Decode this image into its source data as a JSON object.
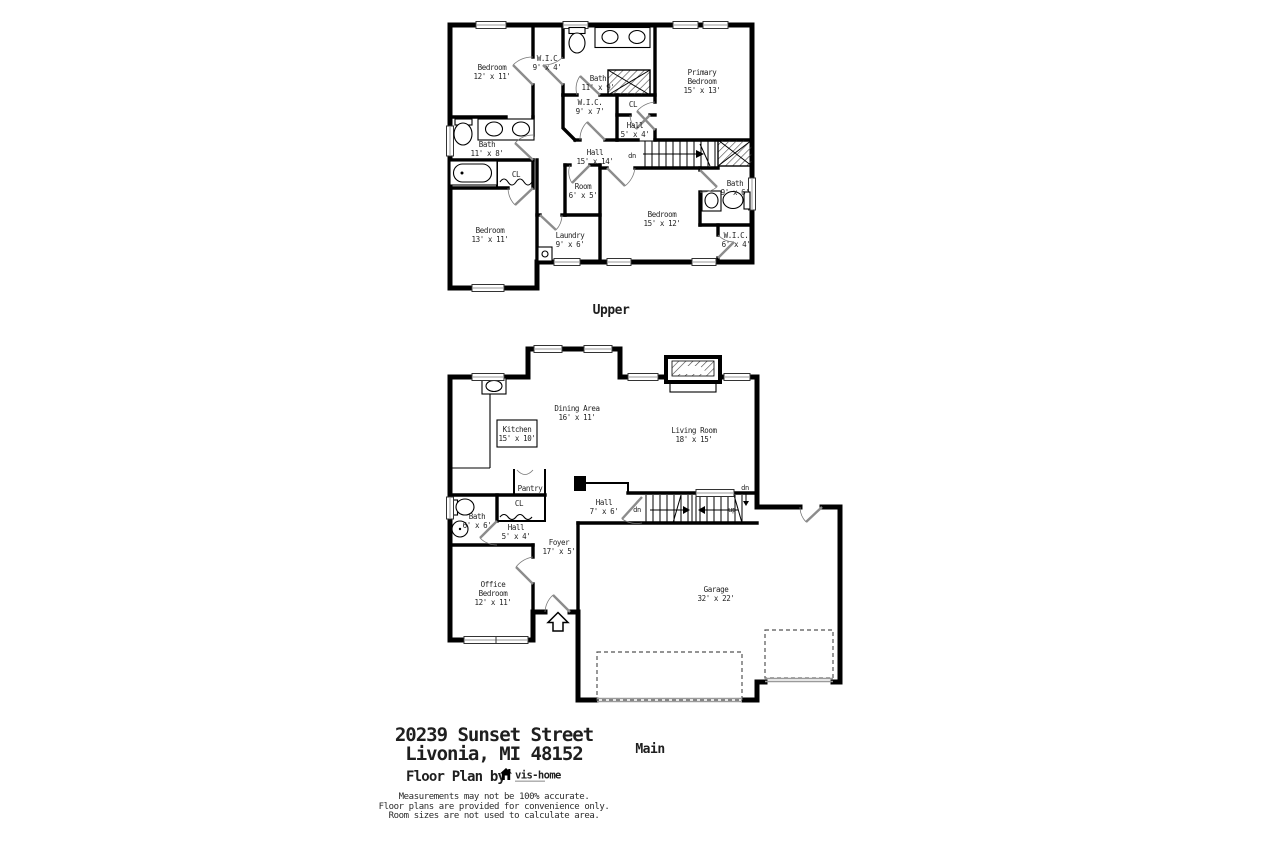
{
  "colors": {
    "wall": "#000000",
    "door_leaf": "#8c8c8c",
    "window_line": "#9a9a9a",
    "text": "#1f1f1f"
  },
  "upper_floor": {
    "label": "Upper",
    "stairs": {
      "dn": "dn"
    },
    "rooms": [
      {
        "id": "bedroom-top-left",
        "lines": [
          "Bedroom",
          "12' x 11'"
        ]
      },
      {
        "id": "wic-top",
        "lines": [
          "W.I.C",
          "9' x 4'"
        ]
      },
      {
        "id": "bath-primary",
        "lines": [
          "Bath",
          "11' x 9'"
        ]
      },
      {
        "id": "primary-bedroom",
        "lines": [
          "Primary",
          "Bedroom",
          "15' x 13'"
        ]
      },
      {
        "id": "wic-middle",
        "lines": [
          "W.I.C.",
          "9' x 7'"
        ]
      },
      {
        "id": "closet-middle",
        "lines": [
          "CL"
        ]
      },
      {
        "id": "hall-small-upper",
        "lines": [
          "Hall",
          "5' x 4'"
        ]
      },
      {
        "id": "bath-left",
        "lines": [
          "Bath",
          "11' x 8'"
        ]
      },
      {
        "id": "closet-left",
        "lines": [
          "CL"
        ]
      },
      {
        "id": "hall-main-upper",
        "lines": [
          "Hall",
          "15' x 14'"
        ]
      },
      {
        "id": "room-small",
        "lines": [
          "Room",
          "6' x 5'"
        ]
      },
      {
        "id": "bedroom-right",
        "lines": [
          "Bedroom",
          "15' x 12'"
        ]
      },
      {
        "id": "bath-right",
        "lines": [
          "Bath",
          "9' x 6'"
        ]
      },
      {
        "id": "bedroom-bottom-left",
        "lines": [
          "Bedroom",
          "13' x 11'"
        ]
      },
      {
        "id": "laundry",
        "lines": [
          "Laundry",
          "9' x 6'"
        ]
      },
      {
        "id": "wic-bottom-right",
        "lines": [
          "W.I.C.",
          "6' x 4'"
        ]
      }
    ]
  },
  "main_floor": {
    "label": "Main",
    "stairs": {
      "dn": "dn",
      "up": "up",
      "dn2": "dn"
    },
    "rooms": [
      {
        "id": "dining-area",
        "lines": [
          "Dining Area",
          "16' x 11'"
        ]
      },
      {
        "id": "kitchen",
        "lines": [
          "Kitchen",
          "15' x 10'"
        ]
      },
      {
        "id": "living-room",
        "lines": [
          "Living Room",
          "18' x 15'"
        ]
      },
      {
        "id": "pantry",
        "lines": [
          "Pantry"
        ]
      },
      {
        "id": "closet-main",
        "lines": [
          "CL"
        ]
      },
      {
        "id": "bath-main",
        "lines": [
          "Bath",
          "6' x 6'"
        ]
      },
      {
        "id": "hall-small-main",
        "lines": [
          "Hall",
          "5' x 4'"
        ]
      },
      {
        "id": "hall-stairs",
        "lines": [
          "Hall",
          "7' x 6'"
        ]
      },
      {
        "id": "foyer",
        "lines": [
          "Foyer",
          "17' x 5'"
        ]
      },
      {
        "id": "office-bedroom",
        "lines": [
          "Office",
          "Bedroom",
          "12' x 11'"
        ]
      },
      {
        "id": "garage",
        "lines": [
          "Garage",
          "32' x 22'"
        ]
      }
    ]
  },
  "footer": {
    "address_line1": "20239 Sunset Street",
    "address_line2": "Livonia, MI 48152",
    "credit": "Floor Plan by",
    "logo_text": "vis-home",
    "disclaimer_line1": "Measurements may not be 100% accurate.",
    "disclaimer_line2": "Floor plans are provided for convenience only.",
    "disclaimer_line3": "Room sizes are not used to calculate area."
  }
}
